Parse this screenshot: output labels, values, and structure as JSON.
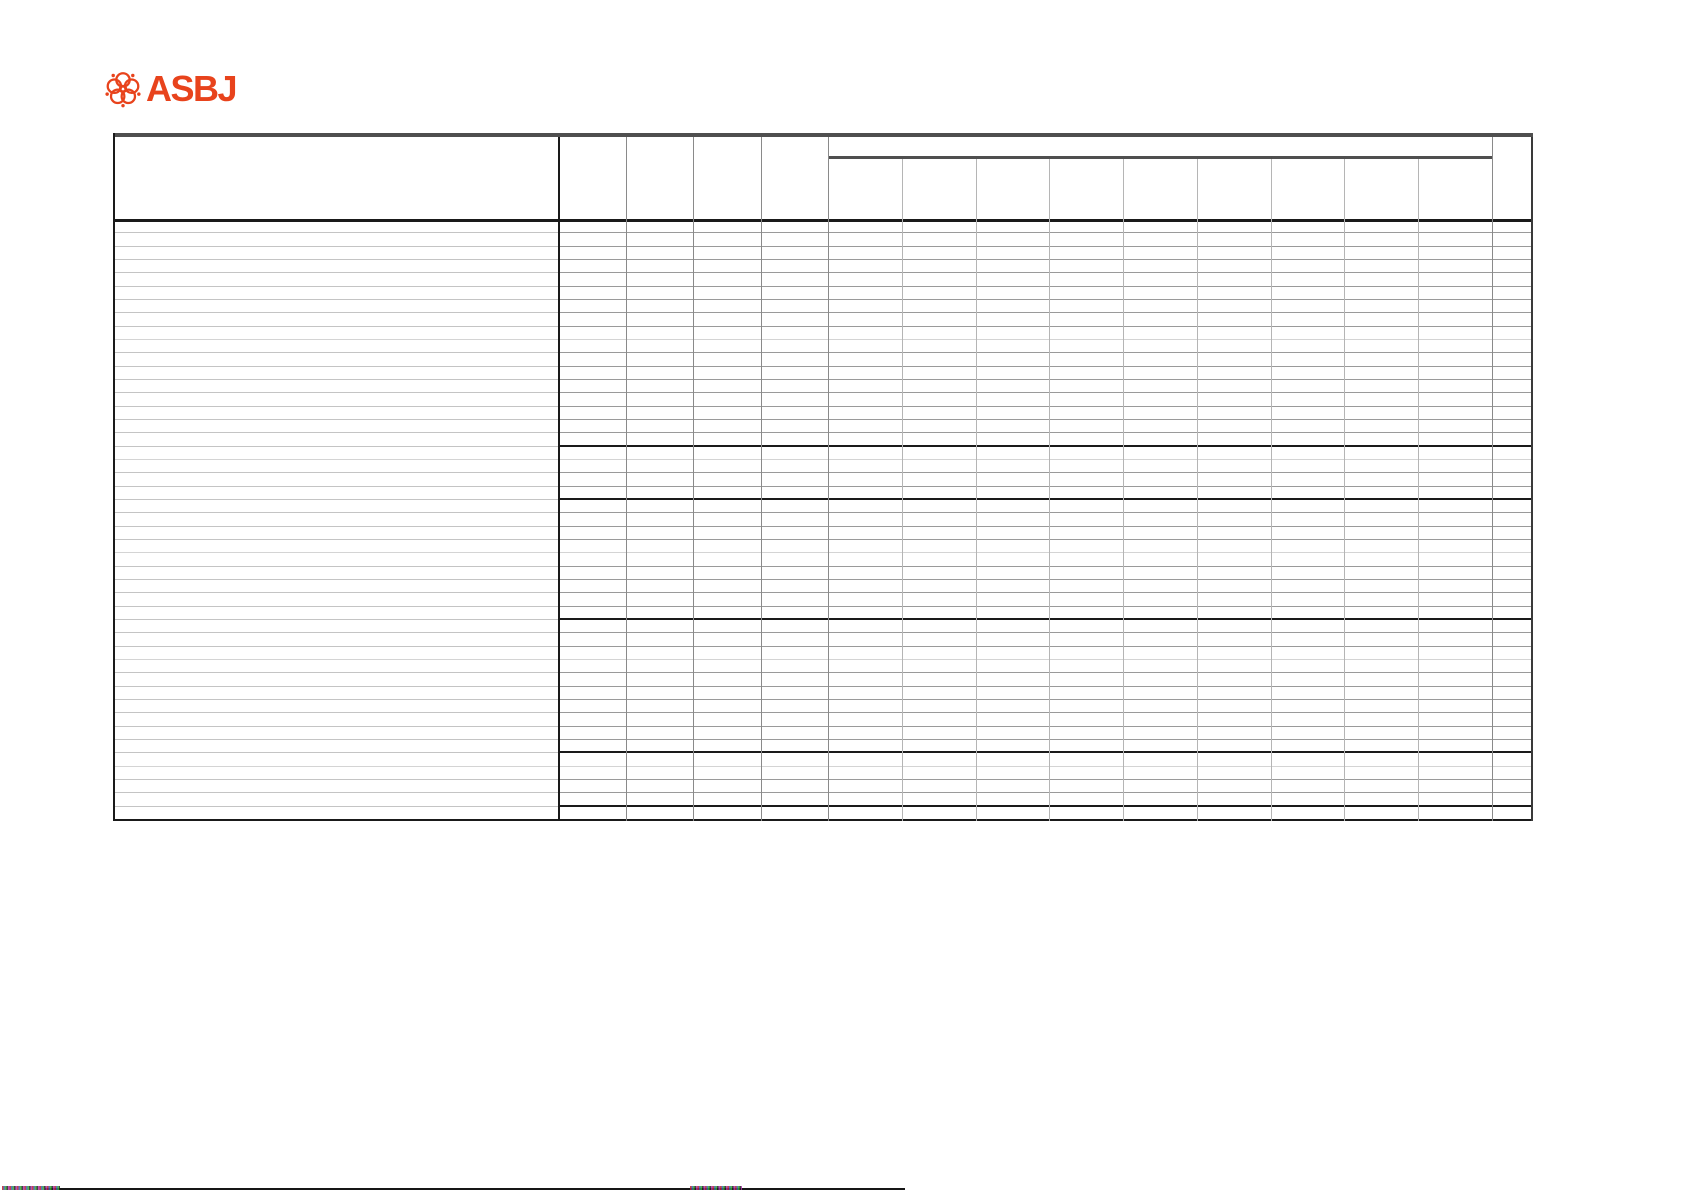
{
  "page": {
    "width": 1685,
    "height": 1192,
    "background": "#ffffff"
  },
  "logo": {
    "text": "ASBJ",
    "color": "#E8431C",
    "icon": "asbj-blossom-icon"
  },
  "table": {
    "x": 113,
    "y": 133,
    "width": 1420,
    "height": 688,
    "header": {
      "height": 86,
      "group_band_height": 23,
      "label_col_width": 445,
      "narrow_col_count": 4,
      "narrow_col_width": 67.5,
      "group_col_count": 9,
      "group_col_width": 73.78,
      "last_col_width": 41,
      "all_header_cells_empty": true
    },
    "body": {
      "row_count": 45,
      "row_pitch": 13.333,
      "section_separators_after_rows": [
        17,
        21,
        30,
        40,
        44
      ],
      "light_row_lines": [
        9,
        18,
        25,
        33,
        41
      ],
      "all_cells_empty": true
    },
    "colors": {
      "frame_dark": "#4f4f4f",
      "frame_black": "#1a1a1a",
      "row_line": "#9a9a9a",
      "row_line_label": "#c4c4c4",
      "row_line_light": "#d4d4d4",
      "col_line": "#8a8a8a",
      "subcol_line": "#b5b5b5",
      "right_border": "#3a3a3a"
    }
  },
  "footer": {
    "rule": {
      "x": 45,
      "y": 1188,
      "width": 860,
      "color": "#161616"
    },
    "microtext_left": {
      "x": 2,
      "y": 1186,
      "width": 58
    },
    "microtext_center": {
      "x": 690,
      "y": 1186,
      "width": 52
    }
  }
}
